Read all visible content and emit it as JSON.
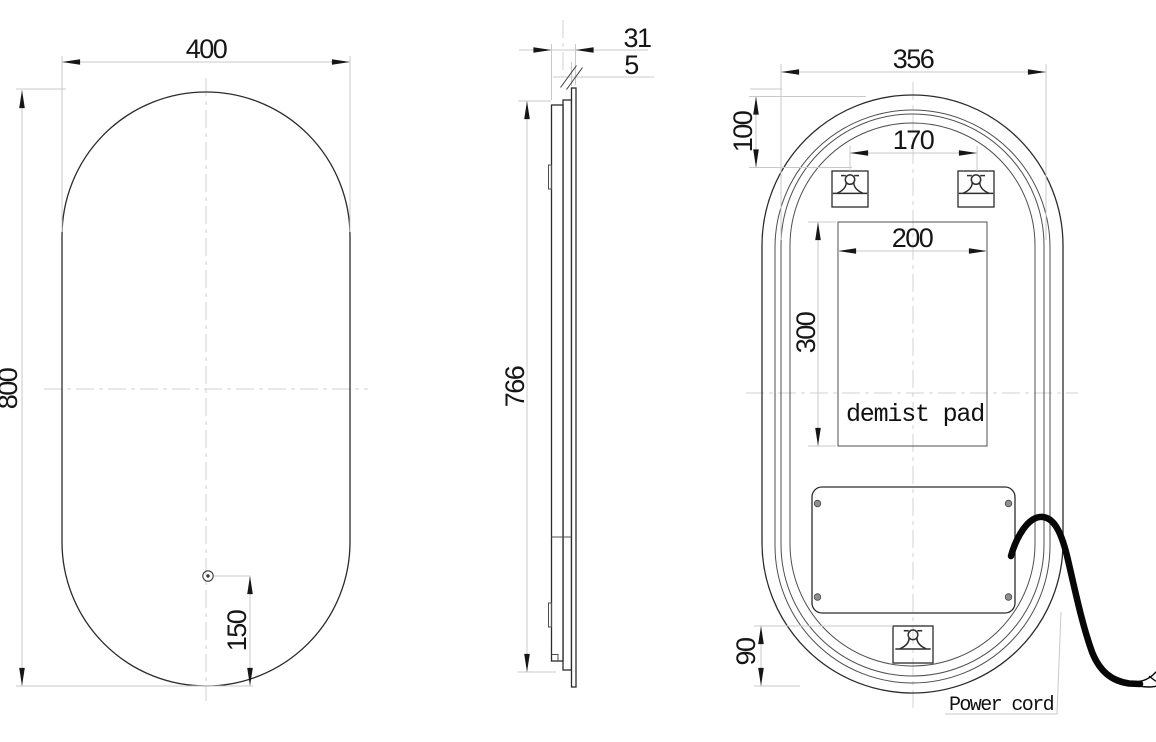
{
  "front_view": {
    "width": "400",
    "height": "800",
    "sensor_offset": "150"
  },
  "side_view": {
    "depth": "31",
    "glass_thickness": "5",
    "body_height": "766"
  },
  "back_view": {
    "frame_width": "356",
    "bracket_top_offset": "100",
    "bracket_spacing": "170",
    "demist_pad_width": "200",
    "demist_pad_height": "300",
    "bracket_bottom_offset": "90",
    "demist_pad_label": "demist pad",
    "power_cord_label": "Power cord"
  },
  "colors": {
    "outline": "#2b2b2b",
    "dimension_line": "#c9c9c9",
    "arrow_and_text": "#161616",
    "centerline": "#ccd2d6",
    "power_cord": "#070707",
    "screw_fill": "#8f8f8f"
  }
}
